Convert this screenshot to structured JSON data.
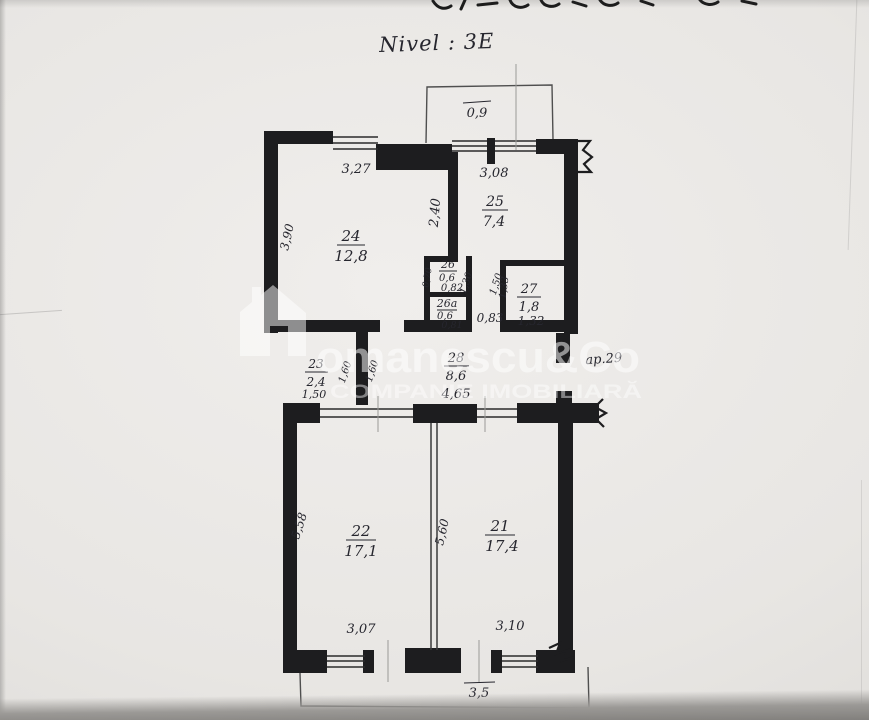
{
  "page": {
    "title": "Nivel : 3E"
  },
  "watermark": {
    "brand": "omanescu&Co",
    "tagline": "COMPANIE IMOBILIARĂ"
  },
  "plan": {
    "apartment_ref": "ap.29",
    "balcony_top_area": "0,9",
    "balcony_bottom_width": "3,5",
    "rooms": {
      "r21": {
        "id": "21",
        "area": "17,4",
        "width": "3,10",
        "height": "5,60"
      },
      "r22": {
        "id": "22",
        "area": "17,1",
        "width": "3,07",
        "height": "5,58"
      },
      "r23": {
        "id": "23",
        "area": "2,4",
        "width": "1,50",
        "height_left": "1,60",
        "height_right": "1,60"
      },
      "r24": {
        "id": "24",
        "area": "12,8",
        "width": "3,27",
        "height": "3,90"
      },
      "r25": {
        "id": "25",
        "area": "7,4",
        "width": "3,08",
        "height": "2,40"
      },
      "r26": {
        "id": "26",
        "area": "0,6",
        "width": "0,82",
        "height": "0,70"
      },
      "r26a": {
        "id": "26a",
        "area": "0,6",
        "width": "0,81"
      },
      "r27": {
        "id": "27",
        "area": "1,8",
        "width": "1,32",
        "height": "1,33"
      },
      "r28": {
        "id": "28",
        "area": "8,6",
        "width": "4,65"
      }
    },
    "lobby": {
      "width": "0,83",
      "depth_left": "1,30",
      "depth_right": "1,50"
    }
  }
}
